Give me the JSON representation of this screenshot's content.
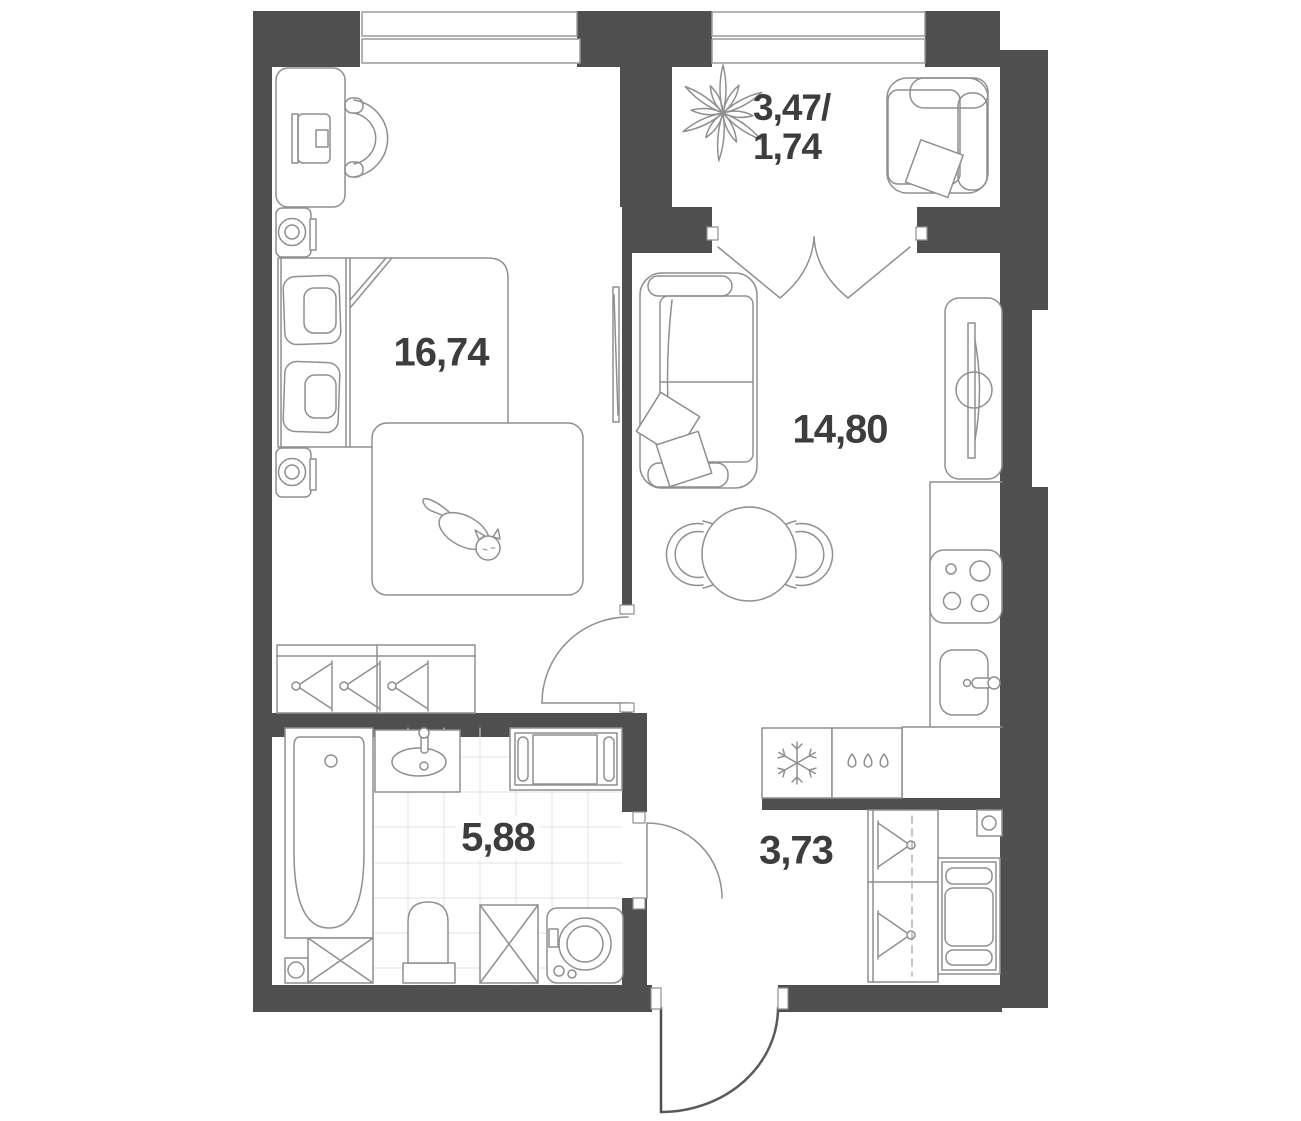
{
  "floorplan": {
    "title": "1-room apartment plan",
    "rooms": [
      {
        "name": "bedroom",
        "area": "16,74"
      },
      {
        "name": "living-kitchen",
        "area": "14,80"
      },
      {
        "name": "bathroom",
        "area": "5,88"
      },
      {
        "name": "hallway",
        "area": "3,73"
      },
      {
        "name": "balcony",
        "area_total": "3,47/",
        "area_counted": "1,74"
      }
    ],
    "labels": {
      "bedroom": "16,74",
      "living_kitchen": "14,80",
      "bathroom": "5,88",
      "hallway": "3,73",
      "balcony_line1": "3,47/",
      "balcony_line2": "1,74"
    },
    "icons": [
      "plant-icon",
      "snowflake-icon",
      "drops-icon",
      "hanger-icon",
      "cat-icon"
    ],
    "colors": {
      "wall": "#4f4f4f",
      "furniture_line": "#8f8f8f",
      "window_line": "#9a9a9a",
      "tile_line": "#e0e0e0",
      "text": "#3d3d3d",
      "background": "#ffffff"
    }
  }
}
